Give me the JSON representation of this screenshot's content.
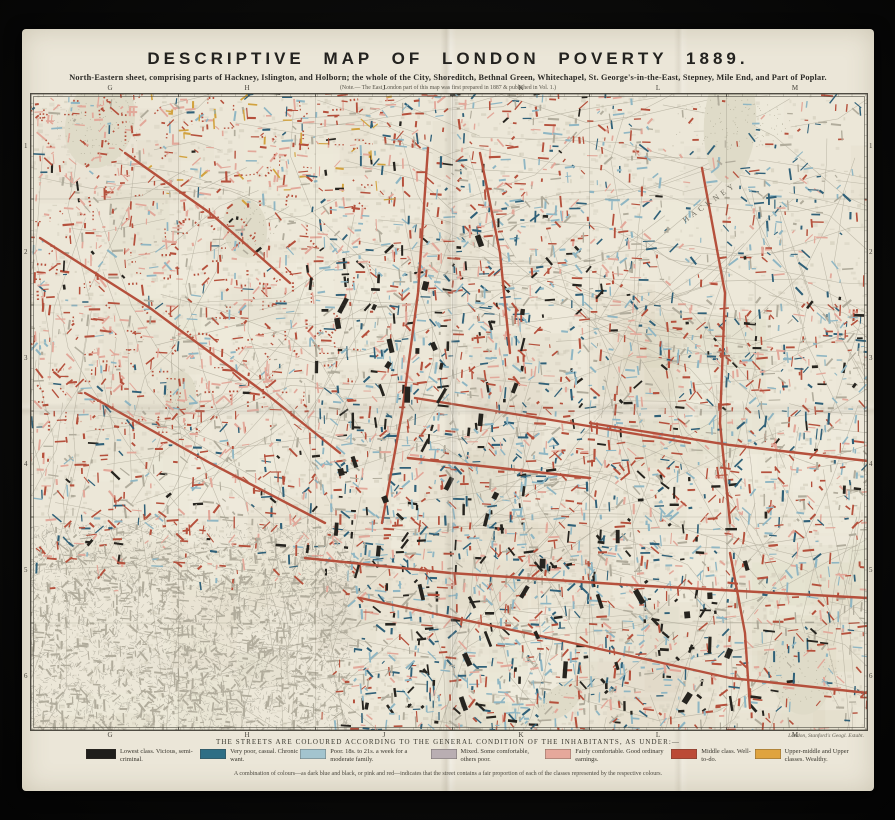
{
  "sheet": {
    "title": "DESCRIPTIVE MAP OF LONDON POVERTY 1889.",
    "subtitle": "North-Eastern sheet, comprising parts of Hackney, Islington, and Holborn; the whole of the City, Shoreditch, Bethnal Green, Whitechapel, St. George's-in-the-East, Stepney, Mile End, and Part of Poplar.",
    "note": "(Note.— The East London part of this map was first prepared in 1887 & published in Vol. 1.)",
    "imprint": "London, Stanford's Geogl. Estabt."
  },
  "grid": {
    "top": [
      "G",
      "H",
      "J",
      "K",
      "L",
      "M"
    ],
    "bottom": [
      "G",
      "H",
      "J",
      "K",
      "L",
      "M"
    ],
    "left": [
      "1",
      "2",
      "3",
      "4",
      "5",
      "6"
    ],
    "right": [
      "1",
      "2",
      "3",
      "4",
      "5",
      "6"
    ]
  },
  "legend": {
    "heading": "THE STREETS ARE COLOURED ACCORDING TO THE GENERAL CONDITION OF THE INHABITANTS, AS UNDER:—",
    "items": [
      {
        "color": "#1f1e1b",
        "label": "Lowest class.  Vicious, semi-criminal."
      },
      {
        "color": "#2e6e85",
        "label": "Very poor, casual.  Chronic want."
      },
      {
        "color": "#a3c4ce",
        "label": "Poor.  18s. to 21s. a week for a moderate family."
      },
      {
        "color": "#b9aeb2",
        "label": "Mixed.  Some comfortable, others poor."
      },
      {
        "color": "#e5a89b",
        "label": "Fairly comfortable.  Good ordinary earnings."
      },
      {
        "color": "#bb4a36",
        "label": "Middle class.  Well-to-do."
      },
      {
        "color": "#dfa33e",
        "label": "Upper-middle and Upper classes.  Wealthy."
      }
    ],
    "footnote": "A combination of colours—as dark blue and black, or pink and red—indicates that the street contains a fair proportion of each of the classes represented by the respective colours."
  },
  "map": {
    "labels": [
      {
        "text": "HACKNEY"
      }
    ],
    "palette": {
      "paper": "#ece7d8",
      "street_grey": "#b1ac9c",
      "building": "#d7d2c1",
      "red": "#b5503c",
      "pink": "#e2a89a",
      "light_blue": "#8fb6c3",
      "dark_blue": "#2f6078",
      "black": "#26241f",
      "yellow": "#d2a23e",
      "city_grey": "#8f8c7f",
      "park": "#dfdbc8",
      "frame": "#4e4b42",
      "grid_line": "#6b675a"
    }
  }
}
